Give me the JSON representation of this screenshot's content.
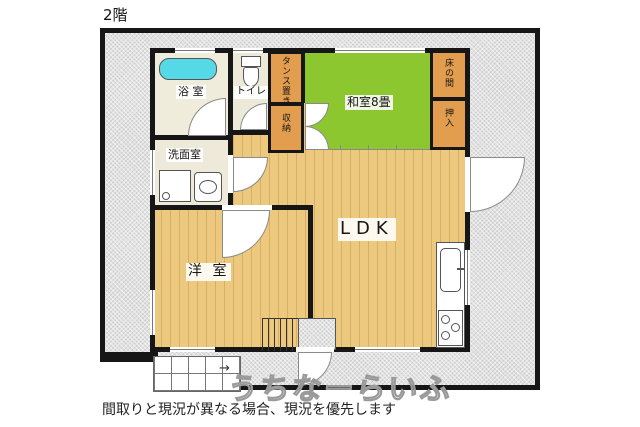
{
  "page": {
    "floor_label": "2階",
    "caption": "間取りと現況が異なる場合、現況を優先します",
    "watermark": "うちなーらいふ"
  },
  "rooms": {
    "bath": {
      "label": "浴 室"
    },
    "toilet": {
      "label": "トイレ"
    },
    "washroom": {
      "label": "洗面室"
    },
    "tansu_space": {
      "label": "タンス置き"
    },
    "storage": {
      "label": "収納"
    },
    "japanese_room": {
      "label": "和室8畳"
    },
    "tokonoma": {
      "label": "床の間"
    },
    "oshiire": {
      "label": "押入"
    },
    "ldk": {
      "label": "LDK"
    },
    "western_room": {
      "label": "洋 室"
    }
  },
  "symbols": {
    "stair_direction_arrow": "→"
  },
  "colors": {
    "tatami_green": "#8dc72f",
    "wood_floor": "#ecc97e",
    "closet_orange": "#e29e4e",
    "bathtub_cyan": "#55d9e6",
    "wall_black": "#161616",
    "hatch_gray": "#e2e2e2"
  }
}
